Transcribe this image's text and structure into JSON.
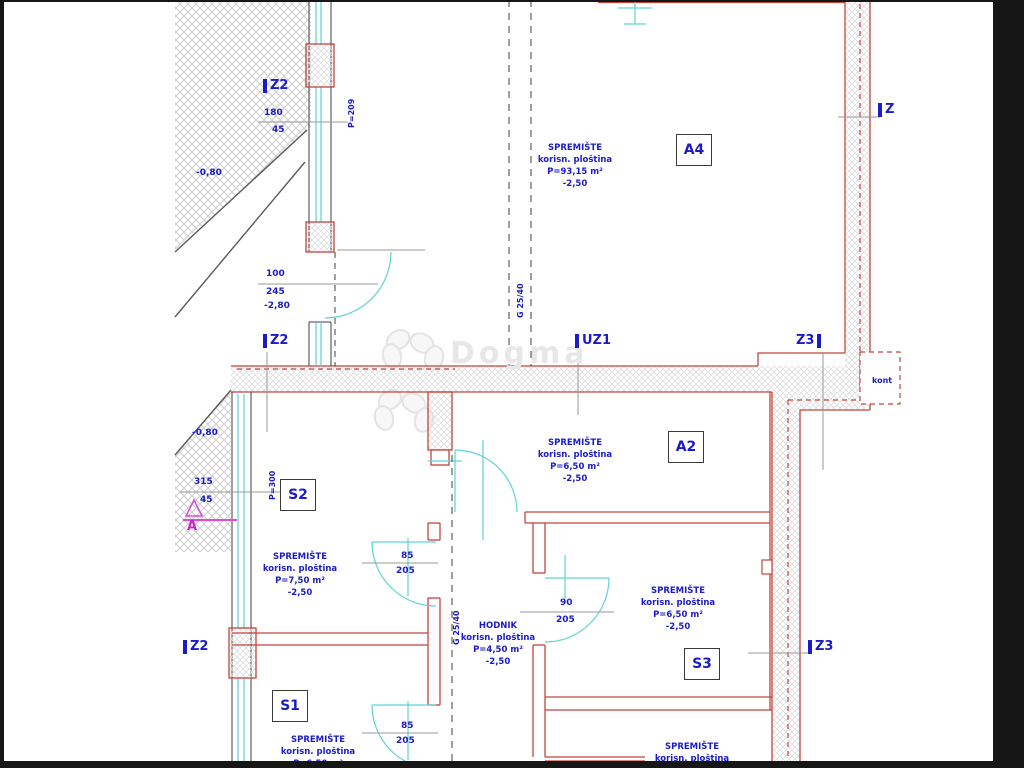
{
  "watermark": "Dogma",
  "labels": {
    "z2": "Z2",
    "z3": "Z3",
    "z": "Z",
    "uz1": "UZ1",
    "kont": "kont",
    "section": "A"
  },
  "rooms": {
    "a4": {
      "tag": "A4",
      "l1": "SPREMIŠTE",
      "l2": "korisn. ploština",
      "l3": "P=93,15 m²",
      "l4": "-2,50"
    },
    "a2": {
      "tag": "A2",
      "l1": "SPREMIŠTE",
      "l2": "korisn. ploština",
      "l3": "P=6,50 m²",
      "l4": "-2,50"
    },
    "s2": {
      "tag": "S2",
      "l1": "SPREMIŠTE",
      "l2": "korisn. ploština",
      "l3": "P=7,50 m²",
      "l4": "-2,50"
    },
    "s3": {
      "tag": "S3",
      "l1": "SPREMIŠTE",
      "l2": "korisn. ploština",
      "l3": "P=6,50 m²",
      "l4": "-2,50"
    },
    "s1": {
      "tag": "S1",
      "l1": "SPREMIŠTE",
      "l2": "korisn. ploština",
      "l3": "P=6,50 m²"
    },
    "hodnik": {
      "l1": "HODNIK",
      "l2": "korisn. ploština",
      "l3": "P=4,50 m²",
      "l4": "-2,50"
    },
    "bottom_right": {
      "l1": "SPREMIŠTE",
      "l2": "korisn. ploština"
    }
  },
  "dims": {
    "win_top_w": "180",
    "win_top_h": "45",
    "door_top_w": "100",
    "door_top_h": "245",
    "level_door": "-2,80",
    "win_s2_w": "315",
    "win_s2_h": "45",
    "terrain_level_top": "-0,80",
    "terrain_level_mid": "-0,80",
    "door_s2_w": "85",
    "door_s2_h": "205",
    "door_hodnik_w": "90",
    "door_hodnik_h": "205",
    "door_s1_w": "85",
    "door_s1_h": "205",
    "parapet_top": "P=209",
    "parapet_s2": "P=300",
    "parapet_s1": "P=300",
    "beam": "G 25/40"
  }
}
